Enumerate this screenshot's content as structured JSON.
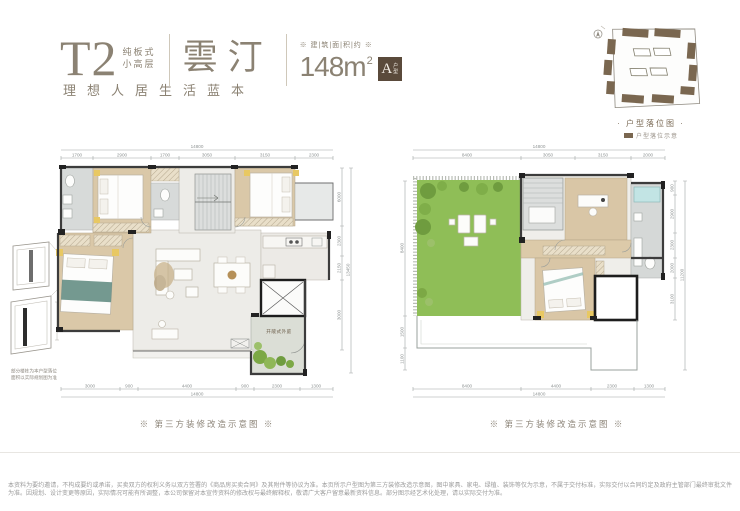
{
  "header": {
    "t2": "T2",
    "t2_sub1": "纯板式",
    "t2_sub2": "小高层",
    "slogan": "理想人居生活蓝本",
    "estate_name": "雲汀",
    "area_label": "※ 建|筑|面|积|约 ※",
    "area_value": "148m",
    "area_sup": "2",
    "badge_letter": "A",
    "badge_sub1": "户",
    "badge_sub2": "型"
  },
  "siteplan": {
    "caption": "· 户型落位图 ·",
    "legend": "户型落位示意"
  },
  "margin_note": {
    "line1": "部分楼栋为本户型落位",
    "line2": "面积以实际规划图为准"
  },
  "plans": {
    "left": {
      "caption": "※ 第三方装修改造示意图 ※",
      "courtyard_label": "开敞式外庭",
      "dim_total_top": "14800",
      "dims_top": [
        "1700",
        "2900",
        "1700",
        "3050",
        "3150",
        "2300"
      ],
      "dims_bottom": [
        "3000",
        "900",
        "4400",
        "900",
        "2300",
        "1300"
      ],
      "dim_total_bottom": "14800",
      "dims_right": [
        "6000",
        "2300",
        "2150",
        "3000"
      ],
      "dim_overall_right": "13450"
    },
    "right": {
      "caption": "※ 第三方装修改造示意图 ※",
      "dim_total_top": "14800",
      "dims_top": [
        "8400",
        "3050",
        "3150",
        "2000"
      ],
      "dims_bottom": [
        "8400",
        "4400",
        "2300",
        "1300"
      ],
      "dim_total_bottom": "14800",
      "dims_right": [
        "900",
        "2900",
        "2300",
        "2000",
        "3100"
      ],
      "dim_overall_right": "11200",
      "dims_left": [
        "8400",
        "1500",
        "1100"
      ]
    }
  },
  "footer": {
    "disclaimer": "本资料为要约邀请，不构成要约或承诺，买卖双方的权利义务以双方签署的《商品房买卖合同》及其附件等协议为准。本页所示户型图为第三方装修改造示意图，图中家具、家电、绿植、装饰等仅为示意，不属于交付标准，实际交付以合同约定及政府主管部门最终审批文件为准。因规划、设计变更等原因，实际情况可能有所调整，本公司保留对本宣传资料的修改权与最终解释权，敬请广大客户留意最新资料信息。部分图示经艺术化处理，请以实际交付为准。"
  },
  "colors": {
    "brand": "#8b8273",
    "badge_bg": "#5a4a3b",
    "lawn": "#8fbe57",
    "wood_floor": "#d9c6a6",
    "wall": "#2e2e2e",
    "siteplan_block": "#7a6750",
    "dim_text": "#8f9494",
    "disclaimer_text": "#9b9b9b"
  }
}
